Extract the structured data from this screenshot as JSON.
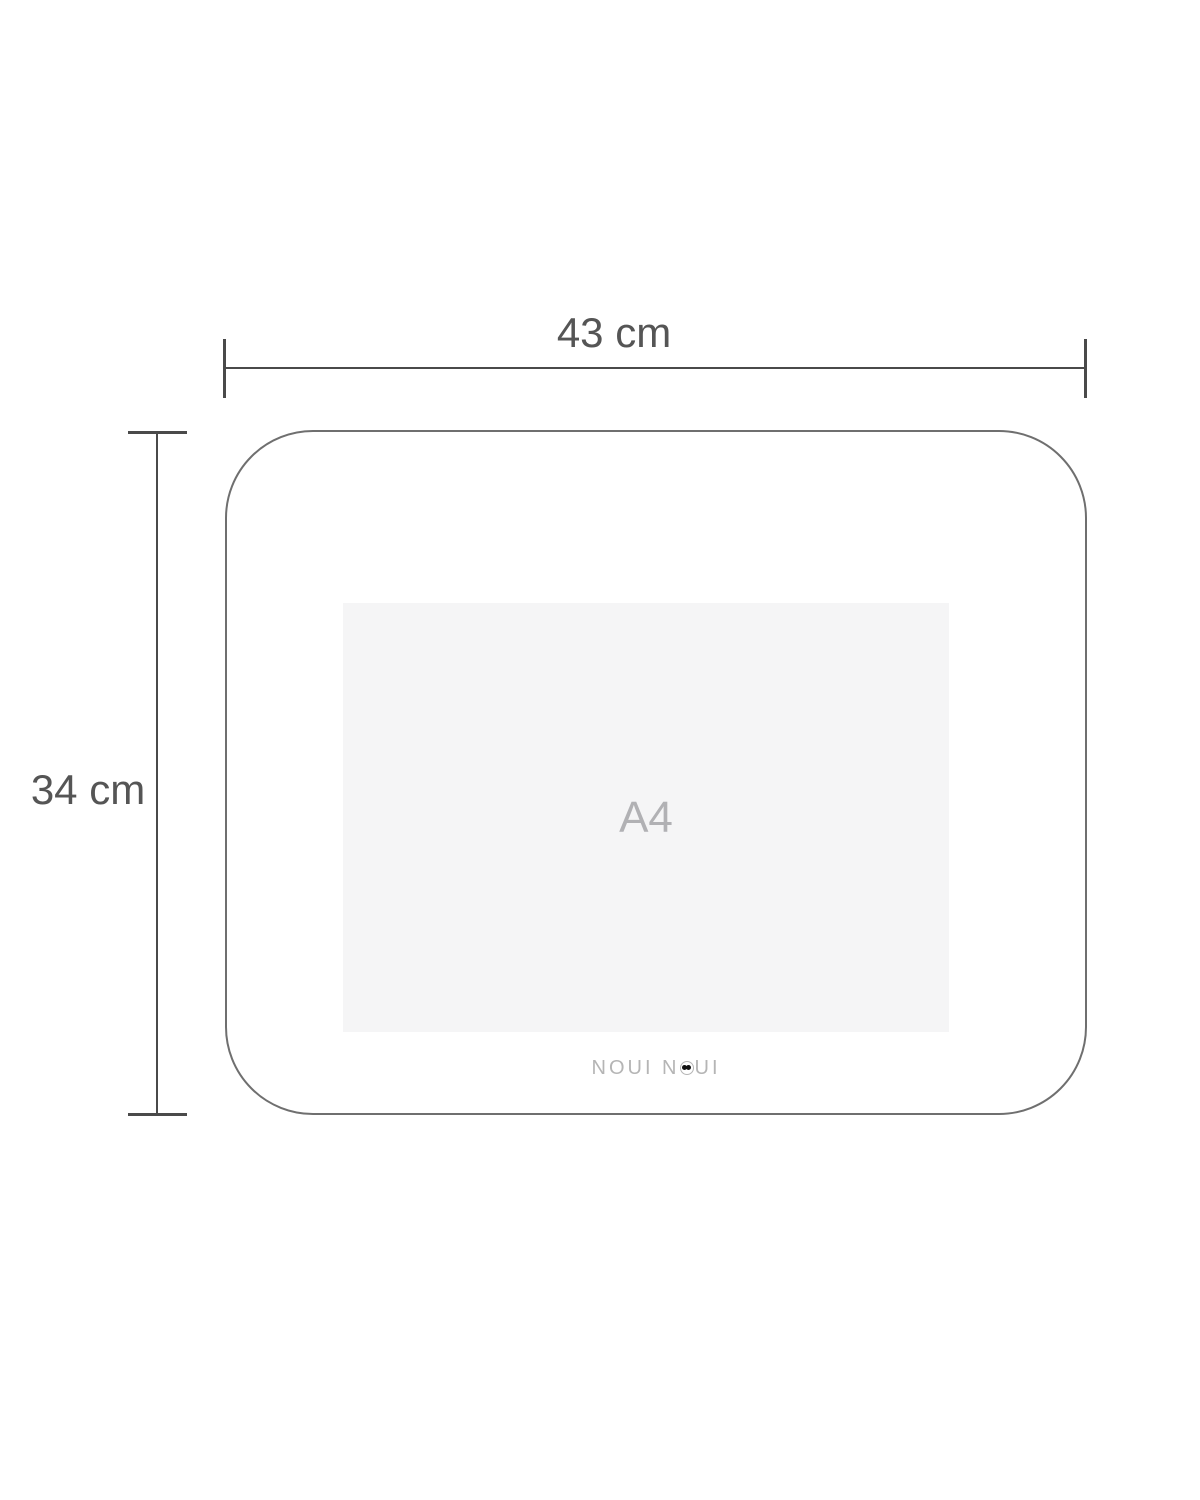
{
  "diagram": {
    "type": "product-dimension-diagram",
    "width_label": "43 cm",
    "height_label": "34 cm",
    "paper_label": "A4",
    "logo": {
      "full_text": "NOUI NOUI",
      "part1": "NOUI N",
      "part2": "UI"
    },
    "colors": {
      "background": "#ffffff",
      "dimension_line": "#4a4a4a",
      "dimension_text": "#555555",
      "placemat_outline": "#6f6f6f",
      "paper_fill": "#f5f5f6",
      "paper_text": "#b1b1b4",
      "logo_text": "#b5b5b5",
      "logo_eyes": "#101010"
    }
  }
}
